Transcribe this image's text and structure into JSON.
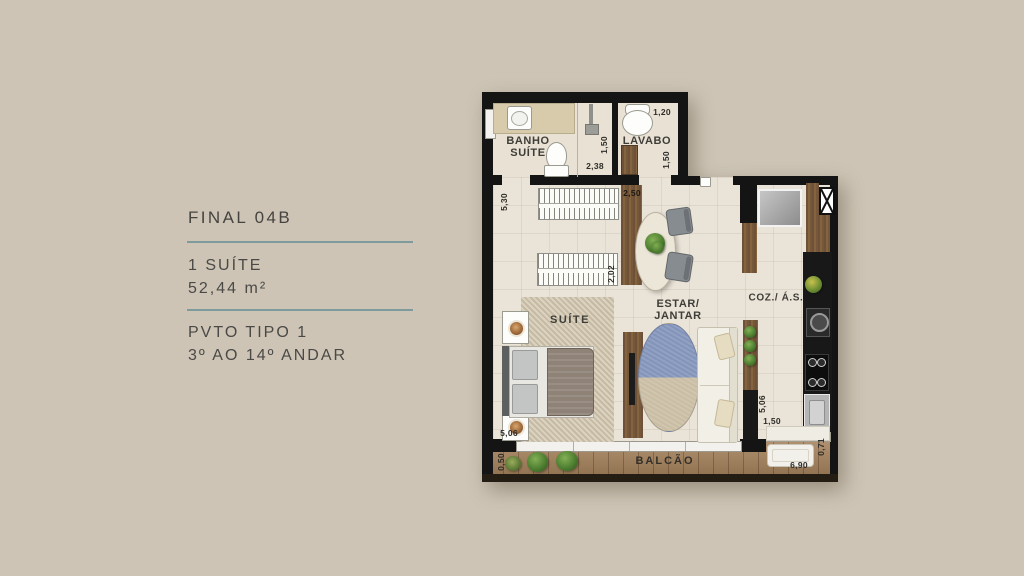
{
  "info_panel": {
    "title": "FINAL 04B",
    "suite_line": "1 SUÍTE",
    "area_line": "52,44 m²",
    "pavement_line": "PVTO TIPO 1",
    "floors_line": "3º AO 14º ANDAR"
  },
  "plan": {
    "rooms": {
      "banho_line1": "BANHO",
      "banho_line2": "SUÍTE",
      "lavabo": "LAVABO",
      "suite": "SUÍTE",
      "estar_line1": "ESTAR/",
      "estar_line2": "JANTAR",
      "cozinha": "COZ./ Á.S.",
      "balcao": "BALCÃO"
    },
    "dimensions": [
      {
        "value": "1,20",
        "location": "lavabo-top"
      },
      {
        "value": "1,50",
        "location": "banho-shower"
      },
      {
        "value": "2,38",
        "location": "banho-bottom"
      },
      {
        "value": "1,50",
        "location": "lavabo-right"
      },
      {
        "value": "5,30",
        "location": "suite-left-top"
      },
      {
        "value": "2,50",
        "location": "partition-top"
      },
      {
        "value": "2,02",
        "location": "wardrobe-side"
      },
      {
        "value": "5,06",
        "location": "suite-bottom-left"
      },
      {
        "value": "5,06",
        "location": "kitchen-left"
      },
      {
        "value": "1,50",
        "location": "kitchen-bottom"
      },
      {
        "value": "0,71",
        "location": "balcony-right"
      },
      {
        "value": "6,90",
        "location": "balcony-bottom-right"
      },
      {
        "value": "0,50",
        "location": "balcony-left"
      }
    ]
  },
  "colors": {
    "background": "#cdc4b5",
    "divider_teal": "#7d9b9d",
    "wall_black": "#141414",
    "wood_brown": "#75573a",
    "rug_blue": "#8394ba"
  }
}
